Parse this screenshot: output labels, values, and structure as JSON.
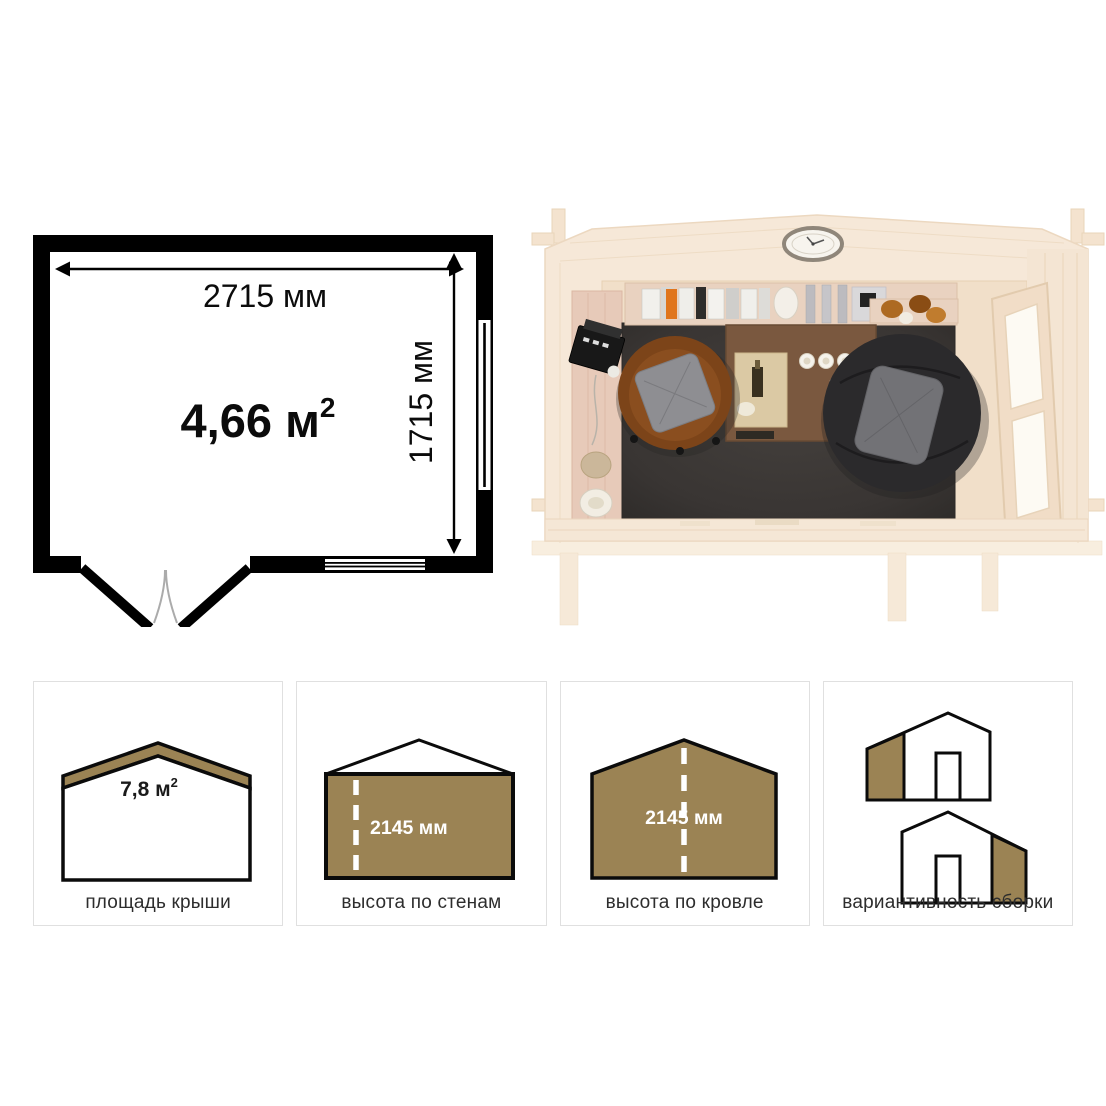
{
  "floorplan": {
    "width_label": "2715 мм",
    "height_label": "1715 мм",
    "area_value": "4,66 м",
    "area_sup": "2"
  },
  "cards": [
    {
      "label": "площадь крыши",
      "value": "7,8 м",
      "sup": "2"
    },
    {
      "label": "высота по стенам",
      "value": "2145 мм"
    },
    {
      "label": "высота по кровле",
      "value": "2145 мм"
    },
    {
      "label": "вариантивность сборки"
    }
  ],
  "colors": {
    "accent_brown": "#9b8354",
    "plan_black": "#000000",
    "card_border": "#e0e0e0",
    "label_text": "#2d2d2d"
  }
}
